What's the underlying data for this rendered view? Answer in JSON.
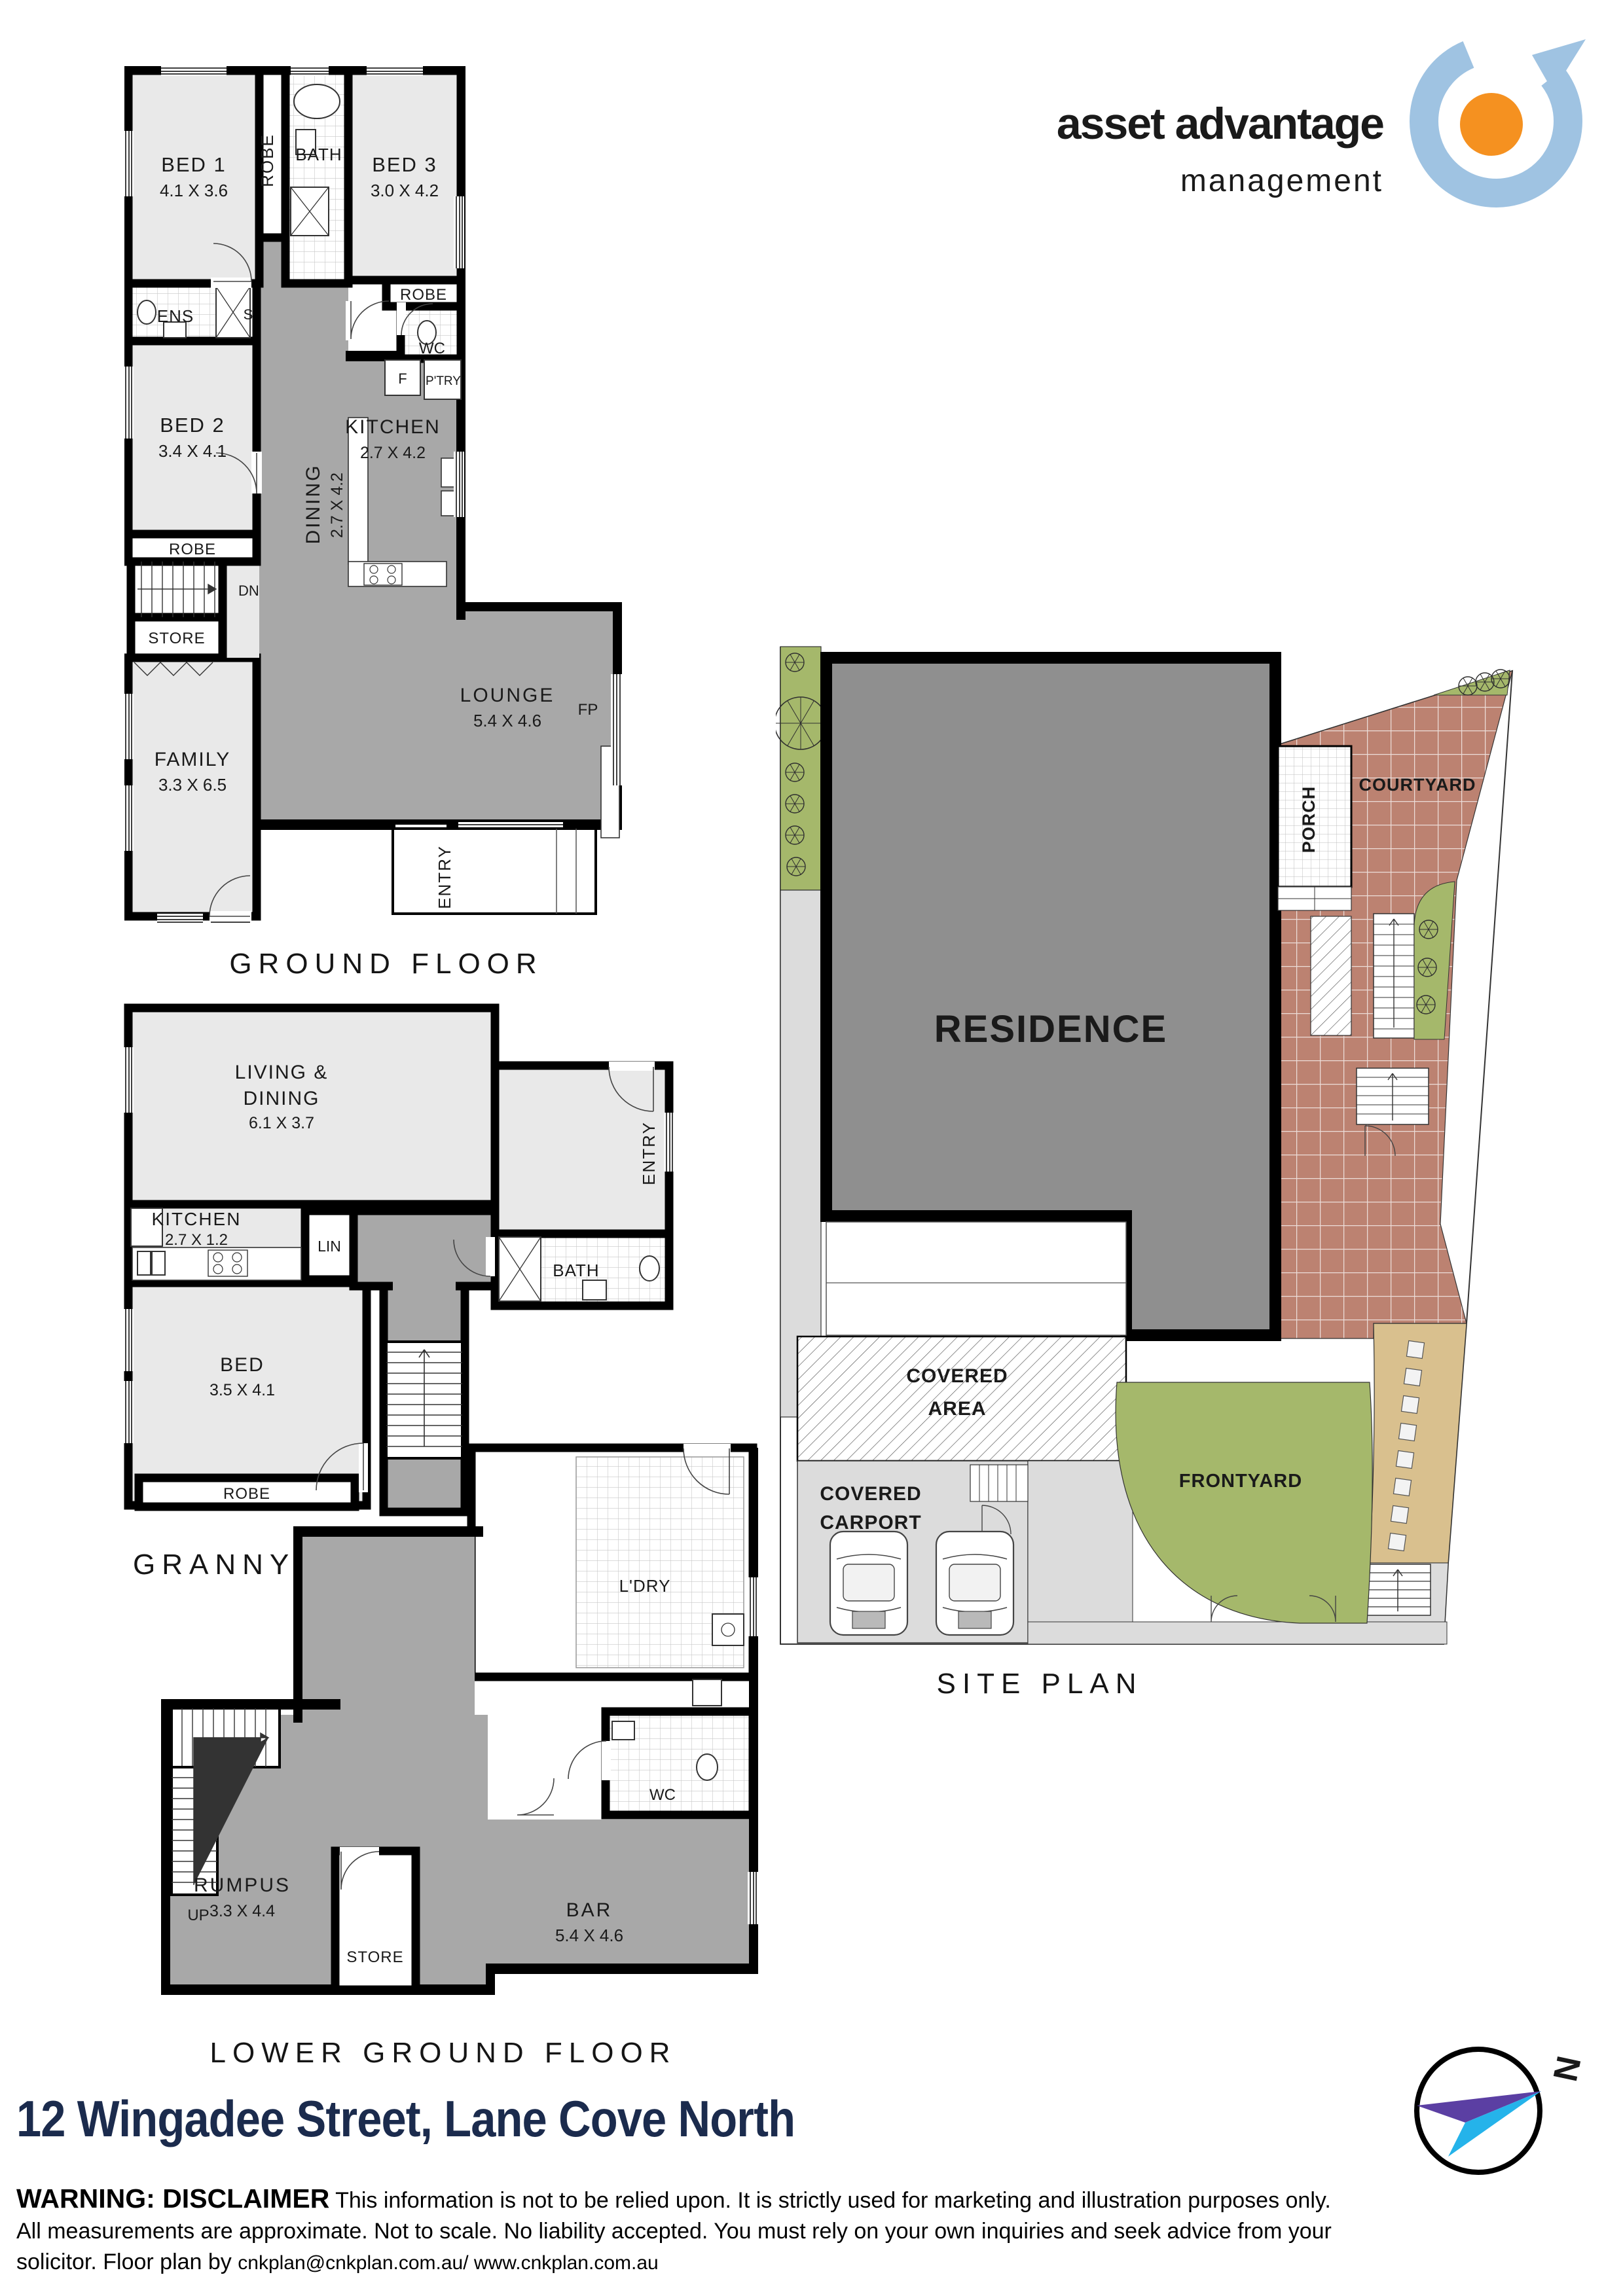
{
  "logo": {
    "title": "asset advantage",
    "subtitle": "management"
  },
  "floors": {
    "ground": {
      "title": "GROUND FLOOR",
      "bed1": "BED 1",
      "bed1_dim": "4.1 X 3.6",
      "robe1": "ROBE",
      "bath": "BATH",
      "bed3": "BED 3",
      "bed3_dim": "3.0 X 4.2",
      "robe3": "ROBE",
      "ens": "ENS",
      "s": "S",
      "wc": "WC",
      "bed2": "BED 2",
      "bed2_dim": "3.4 X 4.1",
      "robe2": "ROBE",
      "dn": "DN",
      "store": "STORE",
      "family": "FAMILY",
      "family_dim": "3.3 X 6.5",
      "dining": "DINING",
      "dining_dim": "2.7 X 4.2",
      "kitchen": "KITCHEN",
      "kitchen_dim": "2.7 X 4.2",
      "f": "F",
      "ptry": "P'TRY",
      "lounge": "LOUNGE",
      "lounge_dim": "5.4 X 4.6",
      "fp": "FP",
      "entry": "ENTRY"
    },
    "granny": {
      "title": "GRANNY FLAT",
      "living1": "LIVING &",
      "living2": "DINING",
      "living_dim": "6.1 X 3.7",
      "kitchen": "KITCHEN",
      "kitchen_dim": "2.7 X 1.2",
      "lin": "LIN",
      "bath": "BATH",
      "entry": "ENTRY",
      "bed": "BED",
      "bed_dim": "3.5 X 4.1",
      "robe": "ROBE"
    },
    "lower": {
      "title": "LOWER GROUND FLOOR",
      "ldry": "L'DRY",
      "wc": "WC",
      "bar": "BAR",
      "bar_dim": "5.4 X 4.6",
      "up": "UP",
      "rumpus": "RUMPUS",
      "rumpus_dim": "3.3 X 4.4",
      "store": "STORE"
    },
    "site": {
      "title": "SITE PLAN",
      "residence": "RESIDENCE",
      "porch": "PORCH",
      "courtyard": "COURTYARD",
      "covered1": "COVERED",
      "covered2": "AREA",
      "carport1": "COVERED",
      "carport2": "CARPORT",
      "frontyard": "FRONTYARD"
    }
  },
  "address": "12 Wingadee Street, Lane Cove North",
  "disclaimer": {
    "lead": "WARNING: DISCLAIMER",
    "line1": "This information is not to be relied upon. It is strictly used for marketing and illustration purposes only.",
    "line2": "All measurements are approximate. Not to scale. No liability accepted. You must rely on your own inquiries and seek advice from your",
    "line3_prefix": "solicitor. Floor plan by",
    "credit": "cnkplan@cnkplan.com.au/ www.cnkplan.com.au"
  },
  "compass": {
    "north": "N"
  },
  "colors": {
    "accent_orange": "#F28B20",
    "logo_blue": "#9FC3E2",
    "address_navy": "#1B2B4D",
    "room_light": "#E9E9E9",
    "room_dark": "#A8A8A8",
    "site_green": "#A5B86B",
    "brick": "#BC8271",
    "sand": "#D9C08E",
    "residence_gray": "#8F8F8F"
  }
}
